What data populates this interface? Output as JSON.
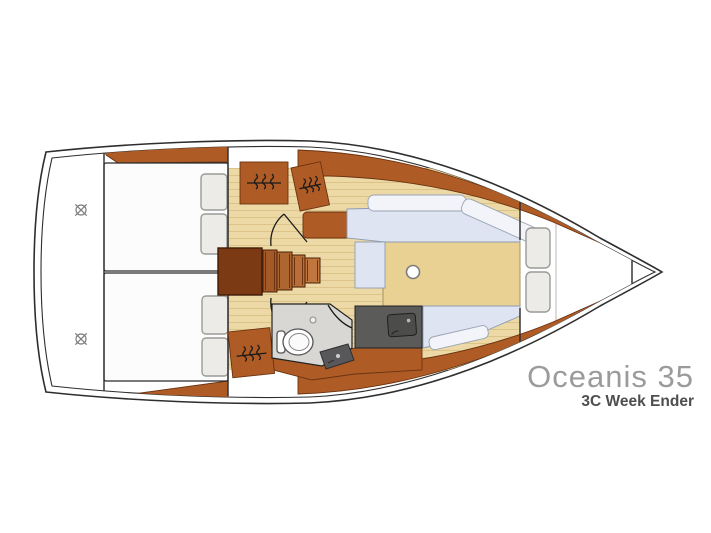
{
  "branding": {
    "model": "Oceanis 35",
    "variant": "3C Week Ender"
  },
  "diagram": {
    "type": "yacht-floor-plan",
    "view": "top-down",
    "orientation": "bow-right",
    "compartments": [
      {
        "name": "transom",
        "features": [
          "swim-platform",
          "two deck fittings"
        ]
      },
      {
        "name": "aft-cabin-port",
        "features": [
          "double berth",
          "two pillows"
        ]
      },
      {
        "name": "aft-cabin-starboard",
        "features": [
          "double berth",
          "two pillows"
        ]
      },
      {
        "name": "companionway",
        "features": [
          "five steps"
        ]
      },
      {
        "name": "hanging-lockers",
        "features": [
          "three wardrobes with hanger symbol"
        ]
      },
      {
        "name": "head",
        "features": [
          "toilet",
          "shower quarter-circle",
          "vanity sink"
        ]
      },
      {
        "name": "galley",
        "features": [
          "worktop",
          "sink"
        ]
      },
      {
        "name": "saloon",
        "features": [
          "port L-settee",
          "starboard settee",
          "table",
          "mast post"
        ]
      },
      {
        "name": "forward-v-berth",
        "features": [
          "two pillows"
        ]
      },
      {
        "name": "bow",
        "features": [
          "anchor locker"
        ]
      }
    ]
  },
  "colors": {
    "hull-line": "#2e2e2e",
    "wood": "#ae5b25",
    "wood-dark": "#6b3310",
    "floor": "#ecd9a6",
    "floor-stripe": "#dcc488",
    "table": "#e9d193",
    "settee": "#dee4f1",
    "cushion": "#f2f4f9",
    "bed": "#fcfcfc",
    "pillow": "#ecebe8",
    "pillow-line": "#9a9a96",
    "counter": "#5b5b59",
    "sink": "#4c4c4a",
    "head-floor": "#d8d7d3",
    "symbol": "#1a1a1a",
    "text-gray": "#9b9b9b",
    "text-dark": "#4e4e4e"
  }
}
